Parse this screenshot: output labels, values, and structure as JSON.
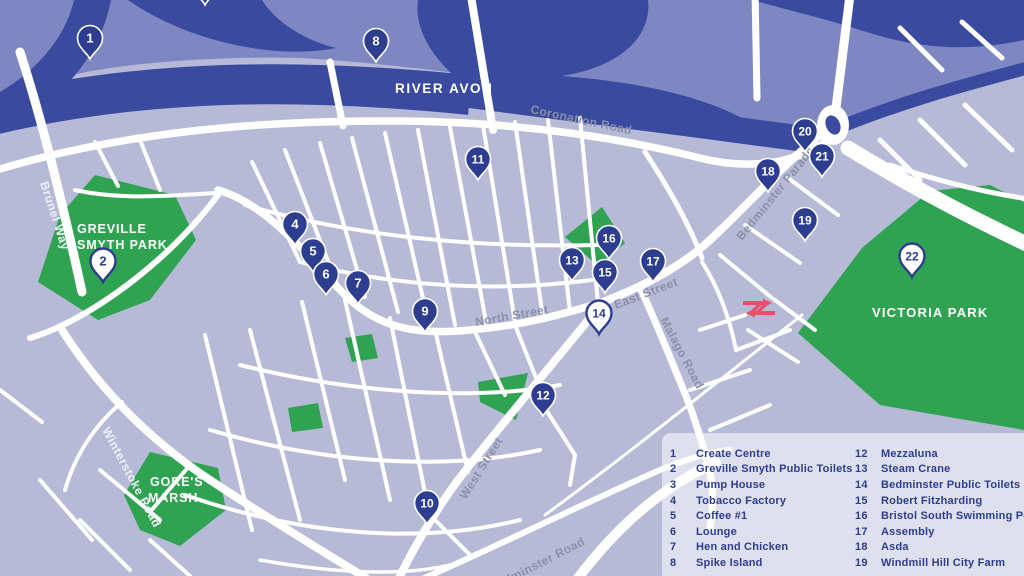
{
  "map": {
    "river_label": "RIVER AVON",
    "parks": {
      "greville_l1": "GREVILLE",
      "greville_l2": "SMYTH PARK",
      "gores_l1": "GORE'S",
      "gores_l2": "MARSH",
      "victoria": "VICTORIA PARK"
    },
    "streets": {
      "coronation": "Coronation Road",
      "north": "North Street",
      "east": "East Street",
      "bedminster_parade": "Bedminster Parade",
      "malago": "Malago Road",
      "west": "West Street",
      "winterstoke": "Winterstoke Road",
      "brunel": "Brunel Way",
      "bedminster_road": "Bedminster Road"
    },
    "colors": {
      "bg_south": "#b6bad7",
      "bg_north": "#7f87c3",
      "water": "#3a4a9f",
      "park_green": "#2fa351",
      "pin_dark": "#2d3d90",
      "road": "#ffffff",
      "label_gray": "#8a90a6",
      "legend_text": "#2d3d90",
      "rail_red": "#e8506a"
    },
    "markers": [
      {
        "n": "1",
        "x": 90,
        "y": 40,
        "variant": "dark"
      },
      {
        "n": "3",
        "x": 205,
        "y": -14,
        "variant": "dark"
      },
      {
        "n": "8",
        "x": 376,
        "y": 43,
        "variant": "dark"
      },
      {
        "n": "11",
        "x": 478,
        "y": 161,
        "variant": "dark"
      },
      {
        "n": "4",
        "x": 295,
        "y": 226,
        "variant": "dark"
      },
      {
        "n": "5",
        "x": 313,
        "y": 253,
        "variant": "dark"
      },
      {
        "n": "6",
        "x": 326,
        "y": 276,
        "variant": "dark"
      },
      {
        "n": "7",
        "x": 358,
        "y": 285,
        "variant": "dark"
      },
      {
        "n": "9",
        "x": 425,
        "y": 313,
        "variant": "dark"
      },
      {
        "n": "2",
        "x": 103,
        "y": 263,
        "variant": "light"
      },
      {
        "n": "13",
        "x": 572,
        "y": 262,
        "variant": "dark"
      },
      {
        "n": "16",
        "x": 609,
        "y": 240,
        "variant": "dark"
      },
      {
        "n": "15",
        "x": 605,
        "y": 274,
        "variant": "dark"
      },
      {
        "n": "17",
        "x": 653,
        "y": 263,
        "variant": "dark"
      },
      {
        "n": "14",
        "x": 599,
        "y": 315,
        "variant": "light"
      },
      {
        "n": "12",
        "x": 543,
        "y": 397,
        "variant": "dark"
      },
      {
        "n": "10",
        "x": 427,
        "y": 505,
        "variant": "dark"
      },
      {
        "n": "18",
        "x": 768,
        "y": 173,
        "variant": "dark"
      },
      {
        "n": "20",
        "x": 805,
        "y": 133,
        "variant": "dark"
      },
      {
        "n": "21",
        "x": 822,
        "y": 158,
        "variant": "dark"
      },
      {
        "n": "19",
        "x": 805,
        "y": 222,
        "variant": "dark"
      },
      {
        "n": "22",
        "x": 912,
        "y": 258,
        "variant": "light"
      }
    ]
  },
  "legend": {
    "columns": [
      {
        "items": [
          {
            "num": "1",
            "label": "Create Centre"
          },
          {
            "num": "2",
            "label": "Greville Smyth Public Toilets"
          },
          {
            "num": "3",
            "label": "Pump House"
          },
          {
            "num": "4",
            "label": "Tobacco Factory"
          },
          {
            "num": "5",
            "label": "Coffee #1"
          },
          {
            "num": "6",
            "label": "Lounge"
          },
          {
            "num": "7",
            "label": "Hen and Chicken"
          },
          {
            "num": "8",
            "label": "Spike Island"
          }
        ]
      },
      {
        "items": [
          {
            "num": "12",
            "label": "Mezzaluna"
          },
          {
            "num": "13",
            "label": "Steam Crane"
          },
          {
            "num": "14",
            "label": "Bedminster Public Toilets"
          },
          {
            "num": "15",
            "label": "Robert Fitzharding"
          },
          {
            "num": "16",
            "label": "Bristol South Swimming Pool"
          },
          {
            "num": "17",
            "label": "Assembly"
          },
          {
            "num": "18",
            "label": "Asda"
          },
          {
            "num": "19",
            "label": "Windmill Hill City Farm"
          }
        ]
      }
    ]
  }
}
